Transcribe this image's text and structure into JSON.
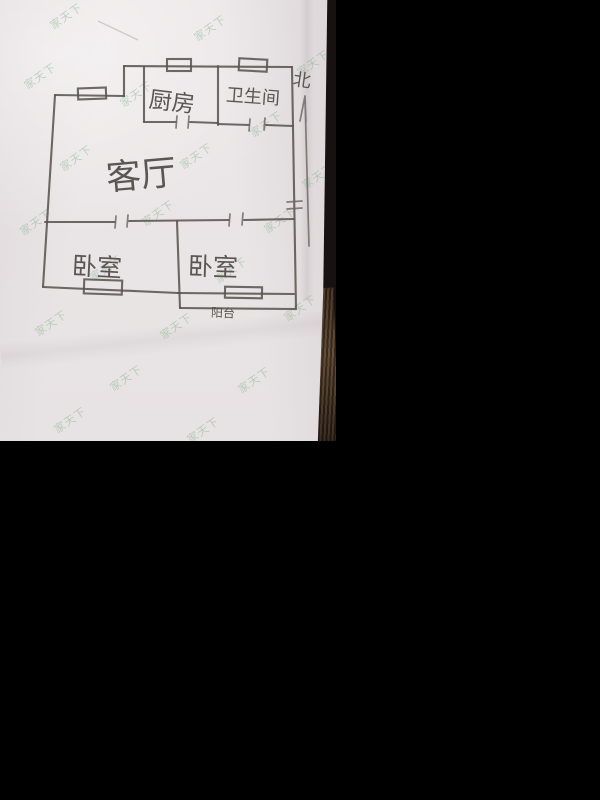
{
  "watermark": {
    "text": "家天下",
    "color": "#74ae7e"
  },
  "floor_plan": {
    "rooms": [
      {
        "name": "kitchen",
        "label": "厨房"
      },
      {
        "name": "bathroom",
        "label": "卫生间"
      },
      {
        "name": "living-room",
        "label": "客厅"
      },
      {
        "name": "bedroom-left",
        "label": "卧室"
      },
      {
        "name": "bedroom-right",
        "label": "卧室"
      },
      {
        "name": "balcony",
        "label": "阳台"
      }
    ],
    "north_indicator": "北"
  },
  "colors": {
    "paper": "#eae5e6",
    "pencil": "#5a5550",
    "photo_background": "#000000",
    "wood_table": "#4a3423",
    "watermark_green": "#74ae7e"
  }
}
